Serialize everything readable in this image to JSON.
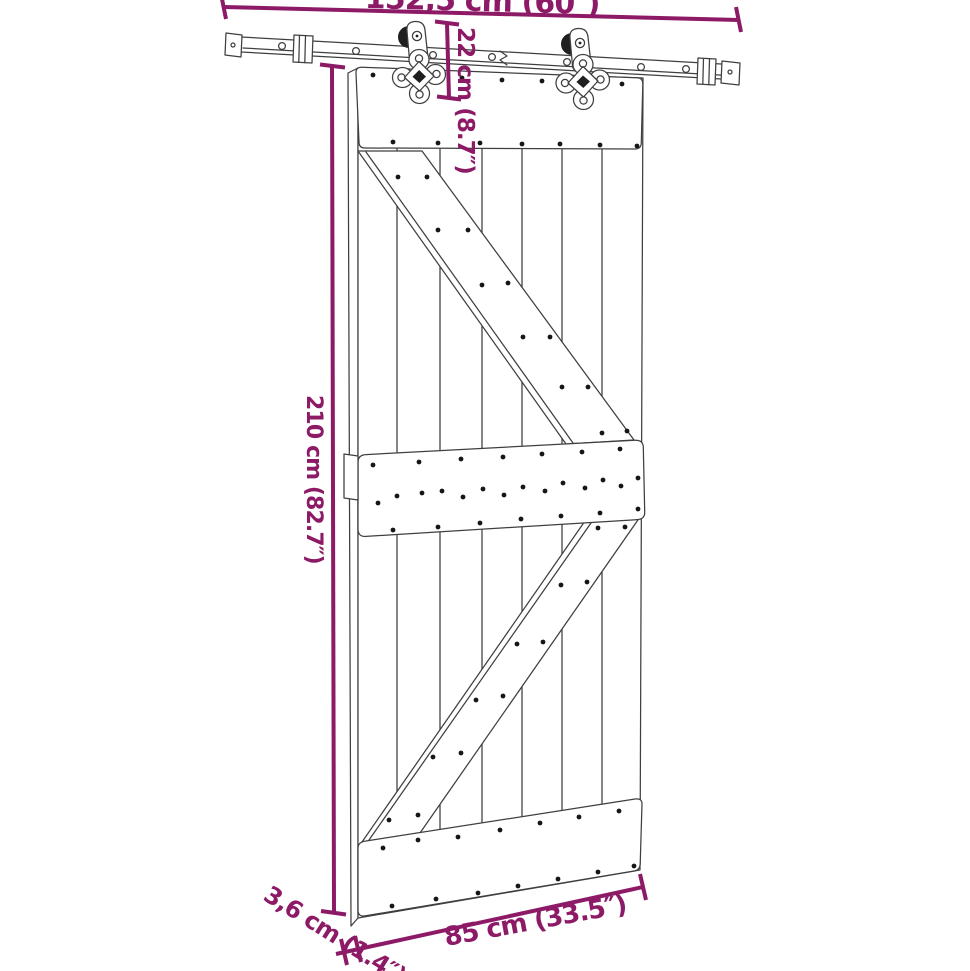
{
  "diagram": {
    "subject": "sliding-barn-door-with-rail-hardware-dimension-drawing",
    "labels": {
      "rail_length": "152,5 cm (60″)",
      "hardware_height": "22 cm (8.7″)",
      "door_height": "210 cm (82.7″)",
      "door_thickness": "3,6 cm (1.4″)",
      "door_width": "85 cm (33.5″)"
    },
    "colors": {
      "dimension": "#8D1A66",
      "line": "#3F3F3F",
      "background": "#FFFFFF"
    }
  }
}
